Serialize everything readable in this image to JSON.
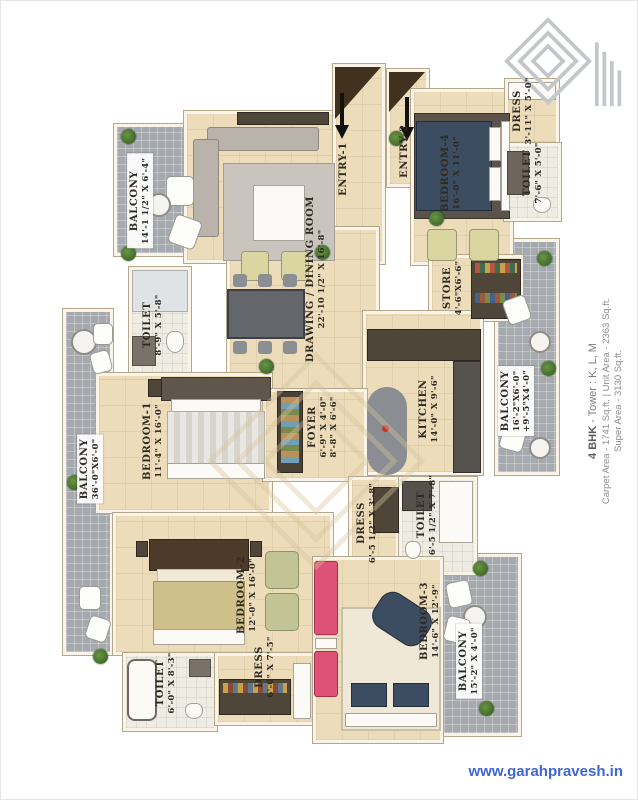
{
  "page": {
    "type": "apartment-floor-plan",
    "website": "www.garahpravesh.in"
  },
  "unit_info": {
    "bhk": "4 BHK",
    "tower": " - Tower : K, L, M",
    "areas_line": "Carpet Area - 1741 Sq.ft. | Unit Area - 2363 Sq.ft.",
    "super_line": "Super Area - 3130 Sq.ft."
  },
  "entries": {
    "entry1": {
      "label": "ENTRY-1"
    },
    "entry2": {
      "label": "ENTRY-2"
    }
  },
  "rooms": {
    "balcony_tl": {
      "name": "BALCONY",
      "dims": "14'-1 1/2\" X 6'-4\""
    },
    "balcony_left": {
      "name": "BALCONY",
      "dims": "36'-0\"X6'-0\""
    },
    "balcony_right": {
      "name": "BALCONY",
      "dims": "16'-2\"X6'-0\"",
      "dims2": "+9'-5\"X4'-0\""
    },
    "balcony_br": {
      "name": "BALCONY",
      "dims": "15'-2\" X 4'-0\""
    },
    "drawing": {
      "name": "DRAWING / DINING ROOM",
      "dims": "22'-10 1/2\" X 16'-8\""
    },
    "kitchen": {
      "name": "KITCHEN",
      "dims": "14'-0\" X 9'-6\""
    },
    "store": {
      "name": "STORE",
      "dims": "4'-6\"X6'-6\""
    },
    "foyer": {
      "name": "FOYER",
      "dims": "6'-9\" X 4'-0\"",
      "dims2": "8'-8\" X 6'-6\""
    },
    "bedroom1": {
      "name": "BEDROOM-1",
      "dims": "11'-4\" X 16'-0\""
    },
    "bedroom2": {
      "name": "BEDROOM-2",
      "dims": "12'-0\" X 16'-0\""
    },
    "bedroom3": {
      "name": "BEDROOM-3",
      "dims": "14'-6\" X 12'-9\""
    },
    "bedroom4": {
      "name": "BEDROOM-4",
      "dims": "16'-0\" X 11'-0\""
    },
    "toilet_l": {
      "name": "TOILET",
      "dims": "8'-9\" X 5'-8\""
    },
    "toilet_tr": {
      "name": "TOILET",
      "dims": "7'-6\" X 5'-0\""
    },
    "toilet_c": {
      "name": "TOILET",
      "dims": "6'-5 1/2\" X 7'-8\""
    },
    "toilet_bl": {
      "name": "TOILET",
      "dims": "6'-0\" X 8'-3\""
    },
    "dress_tr": {
      "name": "DRESS",
      "dims": "3'-11\" X 5'-0\""
    },
    "dress_c": {
      "name": "DRESS",
      "dims": "6'-5 1/2\" X 3'-8\""
    },
    "dress_b": {
      "name": "DRESS",
      "dims": "6'-0\" X 7'-5\""
    }
  },
  "colors": {
    "floor_beige": "#ecdcba",
    "balcony_gray": "#a6aaaf",
    "wall_cream": "#f9f4e7",
    "label_ink": "#2e2a20",
    "link_blue": "#3f66d4",
    "accent_pink": "#df5277",
    "accent_navy": "#3c4d61"
  }
}
